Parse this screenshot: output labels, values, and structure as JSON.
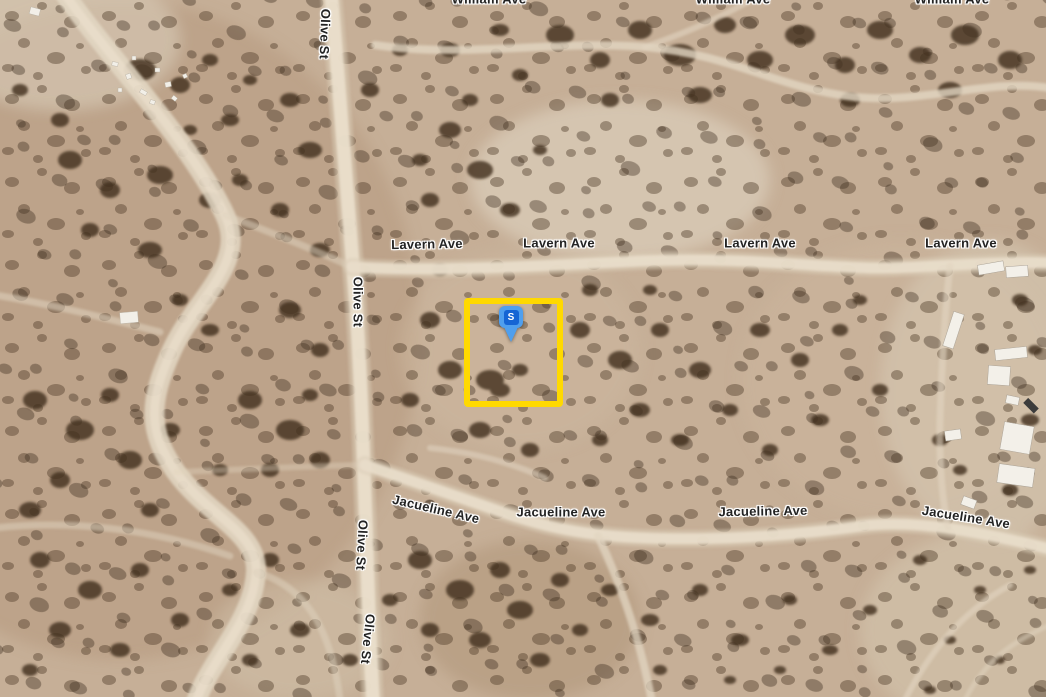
{
  "map": {
    "view_type": "satellite",
    "streets": {
      "olive": "Olive St",
      "lavern": "Lavern Ave",
      "jacueline": "Jacueline Ave",
      "william": "William Ave"
    },
    "marker": {
      "label": "S",
      "balloon_color": "#4f9fee",
      "badge_color": "#1565d4",
      "label_color": "#ffffff"
    },
    "parcel": {
      "outline_color": "#ffd900"
    },
    "label_style": {
      "text_color": "#232323",
      "halo_color": "#ffffff"
    }
  }
}
